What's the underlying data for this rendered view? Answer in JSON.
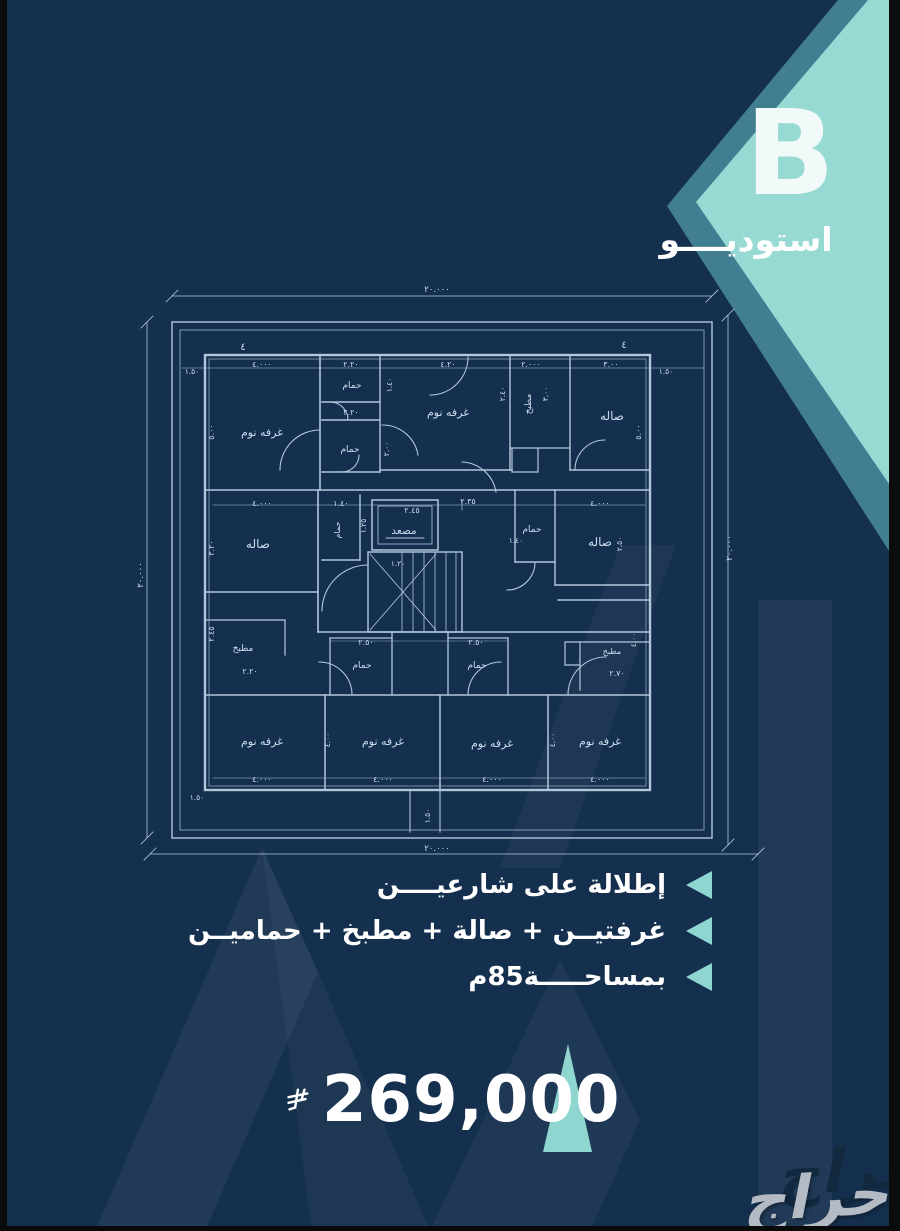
{
  "badge": {
    "letter": "B",
    "label": "استوديــــو"
  },
  "features": [
    {
      "text": "إطلالة على شارعيــــن"
    },
    {
      "text": "غرفتيــن + صالة + مطبخ + حماميــن"
    },
    {
      "text": "بمساحـــــة85م"
    }
  ],
  "price": {
    "amount": "269,000",
    "currency_icon": "saudi-riyal-symbol"
  },
  "watermark": {
    "brand": "حراج"
  },
  "colors": {
    "background": "#15304e",
    "teal_light": "#97d9d3",
    "teal_band": "#417e92",
    "bullet_teal": "#8fd6d0",
    "blueprint_line": "#cfe2f5",
    "text": "#ffffff",
    "watermark_gray": "#b4bbc4"
  },
  "floorplan": {
    "outer_dimensions": {
      "top": "٢٠.٠٠٠",
      "bottom": "٢٠.٠٠٠",
      "left": "٢٠.٠٠٠",
      "right": "٢٠.٠٠٠"
    },
    "texts": [
      {
        "t": "غرفه نوم",
        "x": 262,
        "y": 436,
        "s": 11
      },
      {
        "t": "حمام",
        "x": 352,
        "y": 388,
        "s": 9
      },
      {
        "t": "حمام",
        "x": 350,
        "y": 452,
        "s": 9
      },
      {
        "t": "غرفه نوم",
        "x": 448,
        "y": 416,
        "s": 11
      },
      {
        "t": "مطبخ",
        "x": 531,
        "y": 404,
        "s": 9,
        "r": -90
      },
      {
        "t": "صاله",
        "x": 612,
        "y": 420,
        "s": 12
      },
      {
        "t": "صاله",
        "x": 258,
        "y": 548,
        "s": 12
      },
      {
        "t": "حمام",
        "x": 340,
        "y": 530,
        "s": 8,
        "r": -90
      },
      {
        "t": "مصعد",
        "x": 404,
        "y": 534,
        "s": 10.5
      },
      {
        "t": "حمام",
        "x": 532,
        "y": 532,
        "s": 9
      },
      {
        "t": "صاله",
        "x": 600,
        "y": 546,
        "s": 12
      },
      {
        "t": "مطبخ",
        "x": 243,
        "y": 651,
        "s": 9
      },
      {
        "t": "حمام",
        "x": 362,
        "y": 668,
        "s": 9
      },
      {
        "t": "حمام",
        "x": 477,
        "y": 668,
        "s": 9
      },
      {
        "t": "مطبخ",
        "x": 612,
        "y": 654,
        "s": 8
      },
      {
        "t": "غرفه نوم",
        "x": 262,
        "y": 745,
        "s": 11
      },
      {
        "t": "غرفه نوم",
        "x": 383,
        "y": 745,
        "s": 11
      },
      {
        "t": "غرفه نوم",
        "x": 492,
        "y": 747,
        "s": 11
      },
      {
        "t": "غرفه نوم",
        "x": 600,
        "y": 745,
        "s": 11
      },
      {
        "t": "٢٠.٠٠٠",
        "x": 437,
        "y": 292,
        "s": 8.5
      },
      {
        "t": "٢٠.٠٠٠",
        "x": 437,
        "y": 851,
        "s": 8.5
      },
      {
        "t": "٢٠.٠٠٠",
        "x": 143,
        "y": 575,
        "s": 8.5,
        "r": -90
      },
      {
        "t": "٢٠.٠٠٠",
        "x": 732,
        "y": 548,
        "s": 8.5,
        "r": -90
      },
      {
        "t": "٤.٠٠٠",
        "x": 262,
        "y": 367,
        "s": 8
      },
      {
        "t": "٢.٢٠",
        "x": 351,
        "y": 367,
        "s": 8
      },
      {
        "t": "٤.٢٠",
        "x": 448,
        "y": 367,
        "s": 8
      },
      {
        "t": "٢.٠٠٠",
        "x": 531,
        "y": 367,
        "s": 8
      },
      {
        "t": "٣.٠٠",
        "x": 611,
        "y": 367,
        "s": 8
      },
      {
        "t": "١.٥٠",
        "x": 192,
        "y": 374,
        "s": 7.5
      },
      {
        "t": "١.٥٠",
        "x": 666,
        "y": 374,
        "s": 7.5
      },
      {
        "t": "٥.٠٠",
        "x": 214,
        "y": 432,
        "s": 8,
        "r": -90
      },
      {
        "t": "٥.٠٠",
        "x": 641,
        "y": 432,
        "s": 8,
        "r": -90
      },
      {
        "t": "٢.٢٠",
        "x": 351,
        "y": 415,
        "s": 8
      },
      {
        "t": "٢.٠٠",
        "x": 389,
        "y": 449,
        "s": 7.5,
        "r": -90
      },
      {
        "t": "١.٤٠",
        "x": 392,
        "y": 385,
        "s": 7.5,
        "r": -90
      },
      {
        "t": "٢.٤٠",
        "x": 505,
        "y": 394,
        "s": 7.5,
        "r": -90
      },
      {
        "t": "٣.٠٠",
        "x": 548,
        "y": 394,
        "s": 7.5,
        "r": -90
      },
      {
        "t": "٤.٠٠٠",
        "x": 262,
        "y": 506,
        "s": 8
      },
      {
        "t": "١.٤٠",
        "x": 341,
        "y": 506,
        "s": 8
      },
      {
        "t": "٢.٤٥",
        "x": 412,
        "y": 513,
        "s": 8
      },
      {
        "t": "٢.٣٥",
        "x": 468,
        "y": 504,
        "s": 8
      },
      {
        "t": "١.٤٠",
        "x": 516,
        "y": 543,
        "s": 7.5
      },
      {
        "t": "٤.٠٠٠",
        "x": 600,
        "y": 506,
        "s": 8
      },
      {
        "t": "٣.٢٠",
        "x": 214,
        "y": 548,
        "s": 8,
        "r": -90
      },
      {
        "t": "١.٢٥",
        "x": 366,
        "y": 526,
        "s": 7.5,
        "r": -90
      },
      {
        "t": "١.٢٠",
        "x": 398,
        "y": 566,
        "s": 7.5
      },
      {
        "t": "٢.٥٠",
        "x": 622,
        "y": 544,
        "s": 7.5,
        "r": -90
      },
      {
        "t": "٢.٢٠",
        "x": 250,
        "y": 674,
        "s": 8
      },
      {
        "t": "٢.٤٥",
        "x": 214,
        "y": 634,
        "s": 8,
        "r": -90
      },
      {
        "t": "٢.٥٠",
        "x": 366,
        "y": 645,
        "s": 8
      },
      {
        "t": "٢.٥٠",
        "x": 476,
        "y": 645,
        "s": 8
      },
      {
        "t": "٢.٧٠",
        "x": 617,
        "y": 676,
        "s": 8
      },
      {
        "t": "٤.٠٠",
        "x": 636,
        "y": 640,
        "s": 7.5,
        "r": -90
      },
      {
        "t": "٤.٠٠٠",
        "x": 262,
        "y": 782,
        "s": 8
      },
      {
        "t": "٤.٠٠٠",
        "x": 383,
        "y": 782,
        "s": 8
      },
      {
        "t": "٤.٠٠٠",
        "x": 492,
        "y": 782,
        "s": 8
      },
      {
        "t": "٤.٠٠٠",
        "x": 600,
        "y": 782,
        "s": 8
      },
      {
        "t": "٤.٠٠",
        "x": 330,
        "y": 740,
        "s": 7.5,
        "r": -90
      },
      {
        "t": "٤.٠٠",
        "x": 555,
        "y": 740,
        "s": 7.5,
        "r": -90
      },
      {
        "t": "١.٥٠",
        "x": 197,
        "y": 800,
        "s": 7.5
      },
      {
        "t": "١.٥٠",
        "x": 430,
        "y": 816,
        "s": 7.5,
        "r": -90
      },
      {
        "t": "٤",
        "x": 243,
        "y": 350,
        "s": 10
      },
      {
        "t": "٤",
        "x": 624,
        "y": 348,
        "s": 10
      }
    ]
  }
}
